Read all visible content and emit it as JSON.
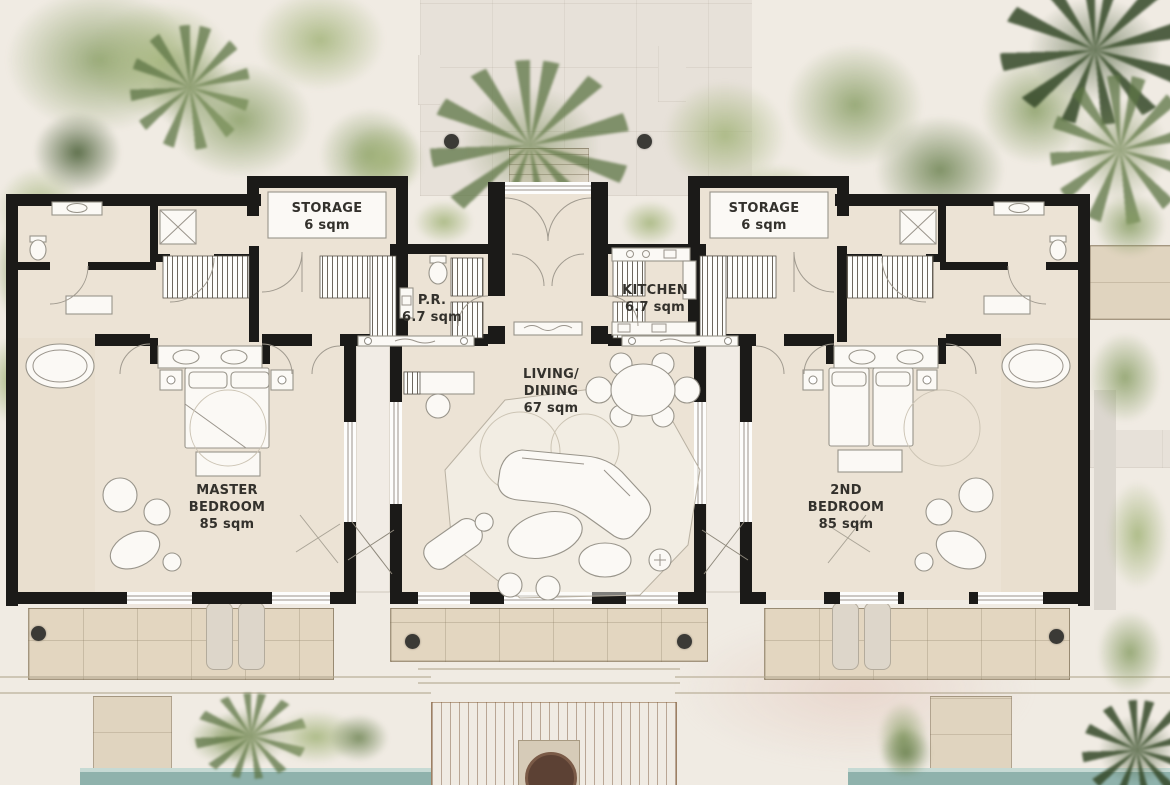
{
  "title": "Villa floor plan",
  "rooms": {
    "storage_left": {
      "name": "STORAGE",
      "area": "6 sqm"
    },
    "storage_right": {
      "name": "STORAGE",
      "area": "6 sqm"
    },
    "powder_room": {
      "name": "P.R.",
      "area": "6.7 sqm"
    },
    "kitchen": {
      "name": "KITCHEN",
      "area": "6.7 sqm"
    },
    "living_dining": {
      "name": "LIVING/\nDINING",
      "area": "67 sqm"
    },
    "master_bedroom": {
      "name": "MASTER\nBEDROOM",
      "area": "85 sqm"
    },
    "second_bedroom": {
      "name": "2ND\nBEDROOM",
      "area": "85 sqm"
    }
  },
  "palette": {
    "bg": "#f0ebe3",
    "wall": "#1b1a18",
    "floor": "#ece3d5",
    "fixture": "#fbf9f5",
    "stone": "#e3d6c0",
    "pad": "#e7e1d9",
    "deck": "#c7976a",
    "pool": "#8fb2ac",
    "poolEdge": "#c6dad4",
    "column": "#3b3a36",
    "label": "#33312c",
    "vegLight": "#a3b47a",
    "vegDark": "#465c33"
  }
}
